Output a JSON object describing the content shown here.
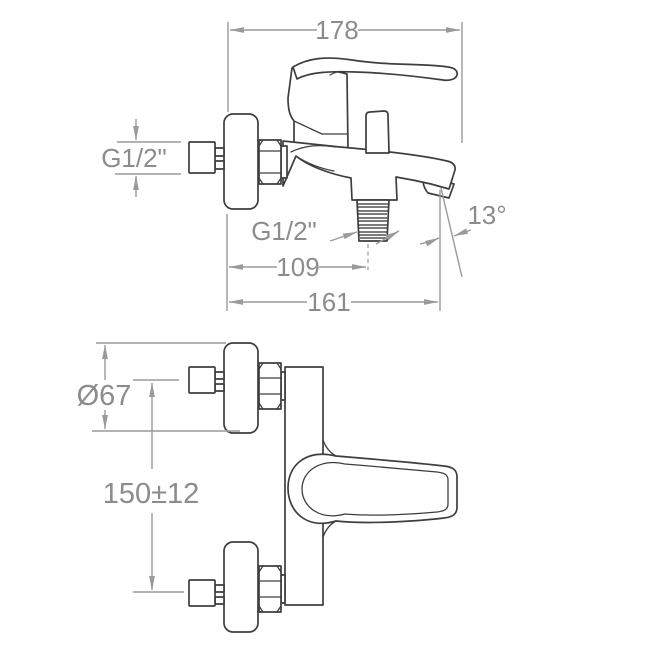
{
  "dimensions": {
    "width_total": "178",
    "inlet_thread": "G1/2\"",
    "outlet_thread": "G1/2\"",
    "spout_angle": "13°",
    "outlet_projection": "109",
    "total_projection": "161",
    "flange_diameter": "Ø67",
    "inlet_centers": "150±12"
  },
  "colors": {
    "background": "#ffffff",
    "object_line": "#3e3e3e",
    "dimension_line": "#9a9a9a",
    "dimension_text": "#8c8c8c"
  }
}
